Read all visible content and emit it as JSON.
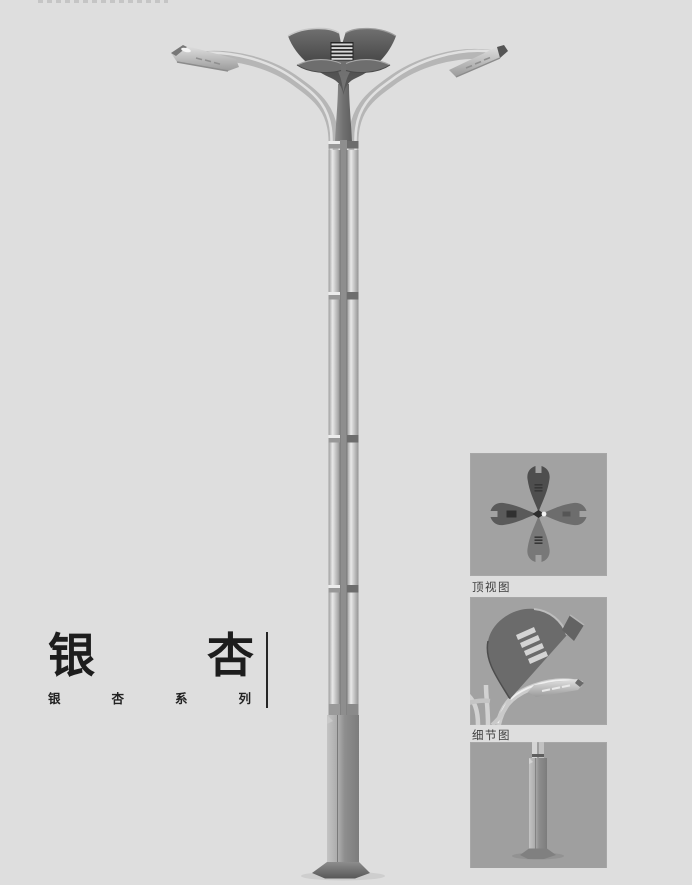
{
  "page": {
    "width": 692,
    "height": 885,
    "background_color": "#dedede"
  },
  "title_block": {
    "title": "银杏",
    "title_chars": [
      "银",
      "杏"
    ],
    "subtitle": "银杏系列",
    "subtitle_chars": [
      "银",
      "杏",
      "系",
      "列"
    ],
    "divider_color": "#262626"
  },
  "illustration": {
    "name": "ginkgo-leaf-double-arm-street-lamp"
  },
  "detail_panels": [
    {
      "id": "top-view",
      "caption": "顶视图",
      "image": "ginkgo-lamp-head-top-view"
    },
    {
      "id": "detail-view",
      "caption": "细节图",
      "image": "ginkgo-lamp-head-close-up"
    },
    {
      "id": "base-view",
      "caption": "",
      "image": "lamp-pole-base-close-up"
    }
  ],
  "colors": {
    "background": "#dedede",
    "panel_background": "#a7a7a7",
    "crown_dark": "#525252",
    "metal_light": "#c6c6c6",
    "text_dark": "#1d1d1d",
    "caption_text": "#3d3d3d"
  }
}
